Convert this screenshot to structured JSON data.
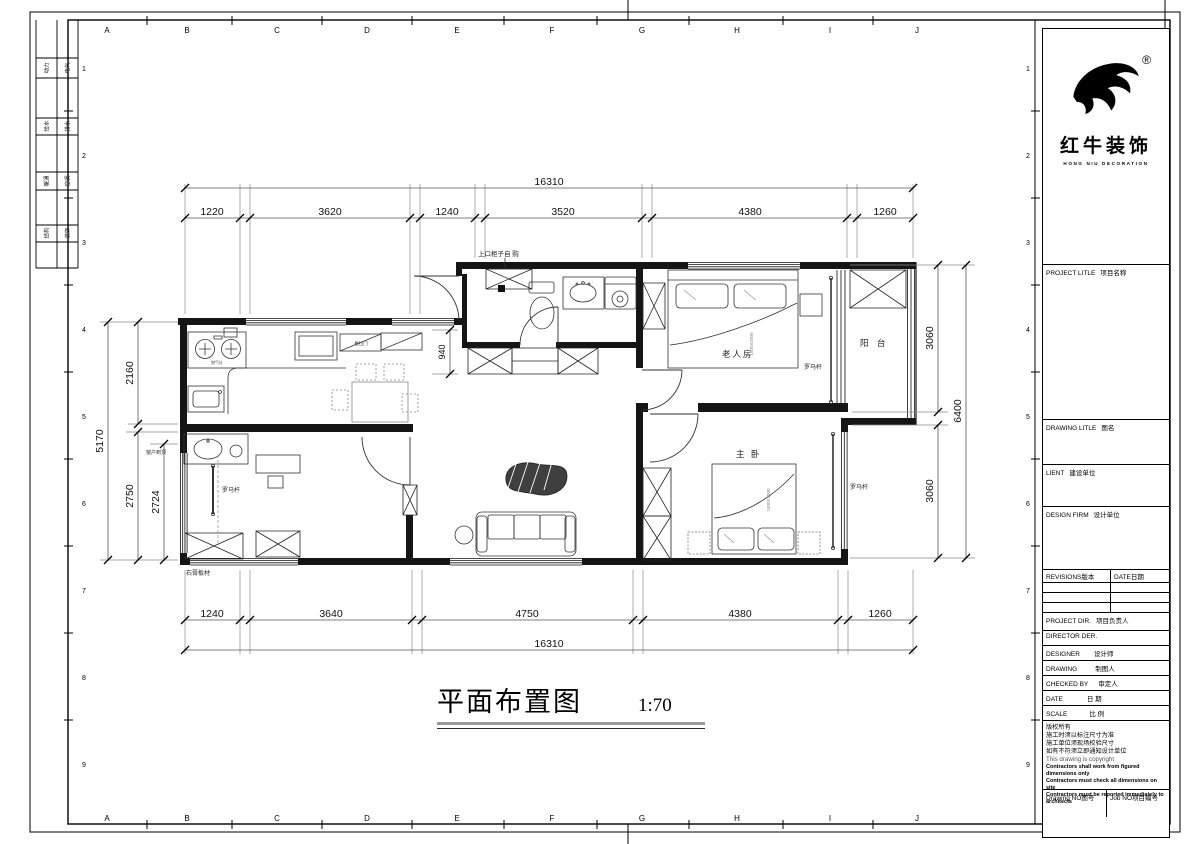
{
  "sheet": {
    "grid_letters": [
      "A",
      "B",
      "C",
      "D",
      "E",
      "F",
      "G",
      "H",
      "I",
      "J"
    ],
    "grid_numbers": [
      "1",
      "2",
      "3",
      "4",
      "5",
      "6",
      "7",
      "8",
      "9"
    ],
    "countersign": [
      "动力",
      "电气",
      "给水",
      "排水",
      "暖通",
      "空调",
      "结构",
      "装饰"
    ]
  },
  "title_block": {
    "logo": {
      "registered": "®",
      "name_cn": "红牛装饰",
      "name_en": "HONG NIU DECORATION"
    },
    "project_title": {
      "en": "PROJECT LITLE",
      "cn": "项目名称"
    },
    "drawing_title": {
      "en": "DRAWING LITLE",
      "cn": "图名"
    },
    "client": {
      "en": "LIENT",
      "cn": "建设单位"
    },
    "design_firm": {
      "en": "DESIGN FIRM",
      "cn": "设计单位"
    },
    "revisions": {
      "en": "REVISIONS",
      "cn": "版本"
    },
    "date_col": {
      "en": "DATE",
      "cn": "日期"
    },
    "project_dir": {
      "en": "PROJECT DIR.",
      "cn": "项目负责人"
    },
    "director": {
      "en": "DIRECTOR DER.",
      "cn": ""
    },
    "designer": {
      "en": "DESIGNER",
      "cn": "设计师"
    },
    "drafter": {
      "en": "DRAWING",
      "cn": "制图人"
    },
    "checked": {
      "en": "CHECKED BY",
      "cn": "审定人"
    },
    "date": {
      "en": "DATE",
      "cn": "日  期"
    },
    "scale": {
      "en": "SCALE",
      "cn": "比  例"
    },
    "copyright": {
      "cn1": "版权所有",
      "cn2": "施工时须以标注尺寸为准",
      "cn3": "施工单位须现场校验尺寸",
      "cn4": "如有不符须立即通知设计单位",
      "en1": "This drawing is copyright",
      "en2": "Contractors shall work from figured dimensions only",
      "en3": "Contractors must check all dimensions on site",
      "en4": "Contractors must be reported immediately to architects"
    },
    "drawing_no": {
      "en": "Drawing NO",
      "cn": "图号"
    },
    "job_no": {
      "en": "Job NO",
      "cn": "项目编号"
    }
  },
  "plan": {
    "title": "平面布置图",
    "scale": "1:70",
    "rooms": {
      "elder": "老人房",
      "master": "主 卧",
      "balcony": "阳 台"
    },
    "labels": {
      "curtain_rod": "罗马杆",
      "upper_cabinet": "上口柜子自 购",
      "window_full": "窗户到顶",
      "gypsum_board": "石膏板材",
      "sliding_door": "推拉门",
      "stove": "燃气灶",
      "elder_bed_size": "1500X2000",
      "master_bed_size": "1800X2000"
    },
    "dims": {
      "top_total": "16310",
      "top": [
        "1220",
        "3620",
        "1240",
        "3520",
        "4380",
        "1260"
      ],
      "bottom": [
        "1240",
        "3640",
        "4750",
        "4380",
        "1260"
      ],
      "bottom_total": "16310",
      "left_total": "5170",
      "left": [
        "2160",
        "2750",
        "2724"
      ],
      "right": [
        "3060",
        "3060",
        "6400"
      ],
      "hall": "940"
    }
  }
}
